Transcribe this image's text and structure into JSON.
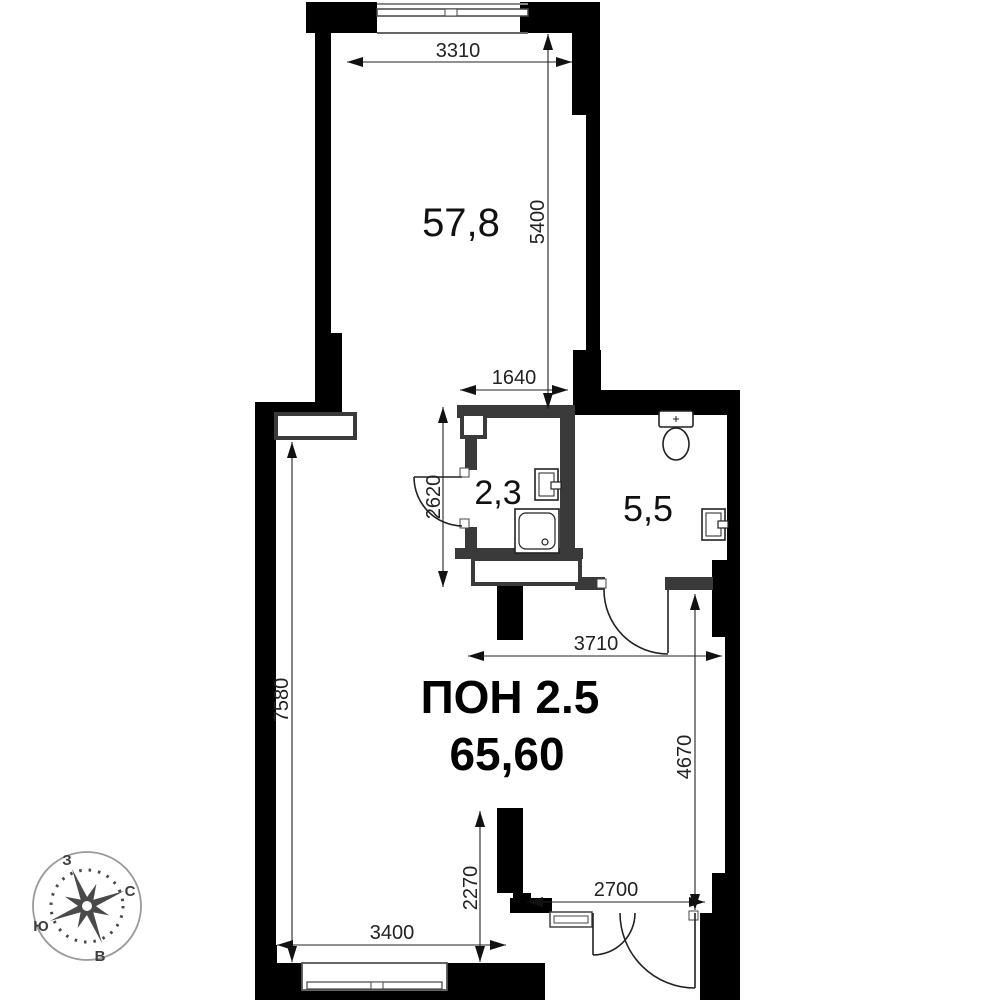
{
  "plan_title": {
    "unit": "ПОН 2.5",
    "total_area": "65,60"
  },
  "rooms": {
    "top": {
      "area": "57,8"
    },
    "wc": {
      "area": "2,3"
    },
    "bath": {
      "area": "5,5"
    }
  },
  "dimensions_mm": {
    "d3310": "3310",
    "d5400": "5400",
    "d1640": "1640",
    "d2620": "2620",
    "d7580": "7580",
    "d3710": "3710",
    "d4670": "4670",
    "d2270": "2270",
    "d2700": "2700",
    "d3400": "3400"
  },
  "compass": {
    "west": "З",
    "north": "С",
    "south": "Ю",
    "east": "В"
  },
  "colors": {
    "wall": "#000000",
    "partition": "#3a3a3a",
    "line": "#222222",
    "compass": "#4a4a4a"
  }
}
